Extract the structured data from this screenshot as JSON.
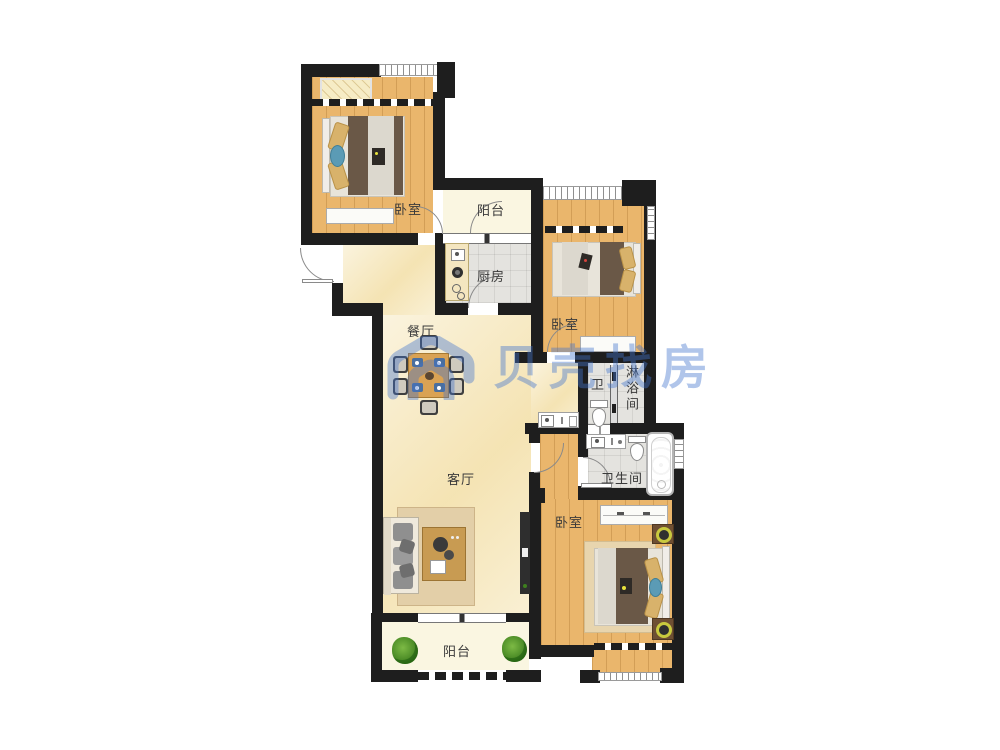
{
  "floor_plan": {
    "watermark": {
      "text": "贝壳找房",
      "color": "#4274CE"
    },
    "rooms": [
      {
        "id": "bedroom-top-left",
        "label": "卧室"
      },
      {
        "id": "balcony-top",
        "label": "阳台"
      },
      {
        "id": "kitchen",
        "label": "厨房"
      },
      {
        "id": "bedroom-middle-right",
        "label": "卧室"
      },
      {
        "id": "dining-room",
        "label": "餐厅"
      },
      {
        "id": "water-closet",
        "label": "卫"
      },
      {
        "id": "shower-room",
        "label": "淋浴间"
      },
      {
        "id": "living-room",
        "label": "客厅"
      },
      {
        "id": "bathroom",
        "label": "卫生间"
      },
      {
        "id": "bedroom-bottom-right",
        "label": "卧室"
      },
      {
        "id": "balcony-bottom",
        "label": "阳台"
      }
    ],
    "colors": {
      "wall": "#1e1e1e",
      "wood_floor": "#EAB66C",
      "marble_floor": "#F7EAC3",
      "tile_floor": "#E4E3DF",
      "balcony_floor": "#FAF6E1",
      "watermark_blue": "#4274CE"
    }
  }
}
